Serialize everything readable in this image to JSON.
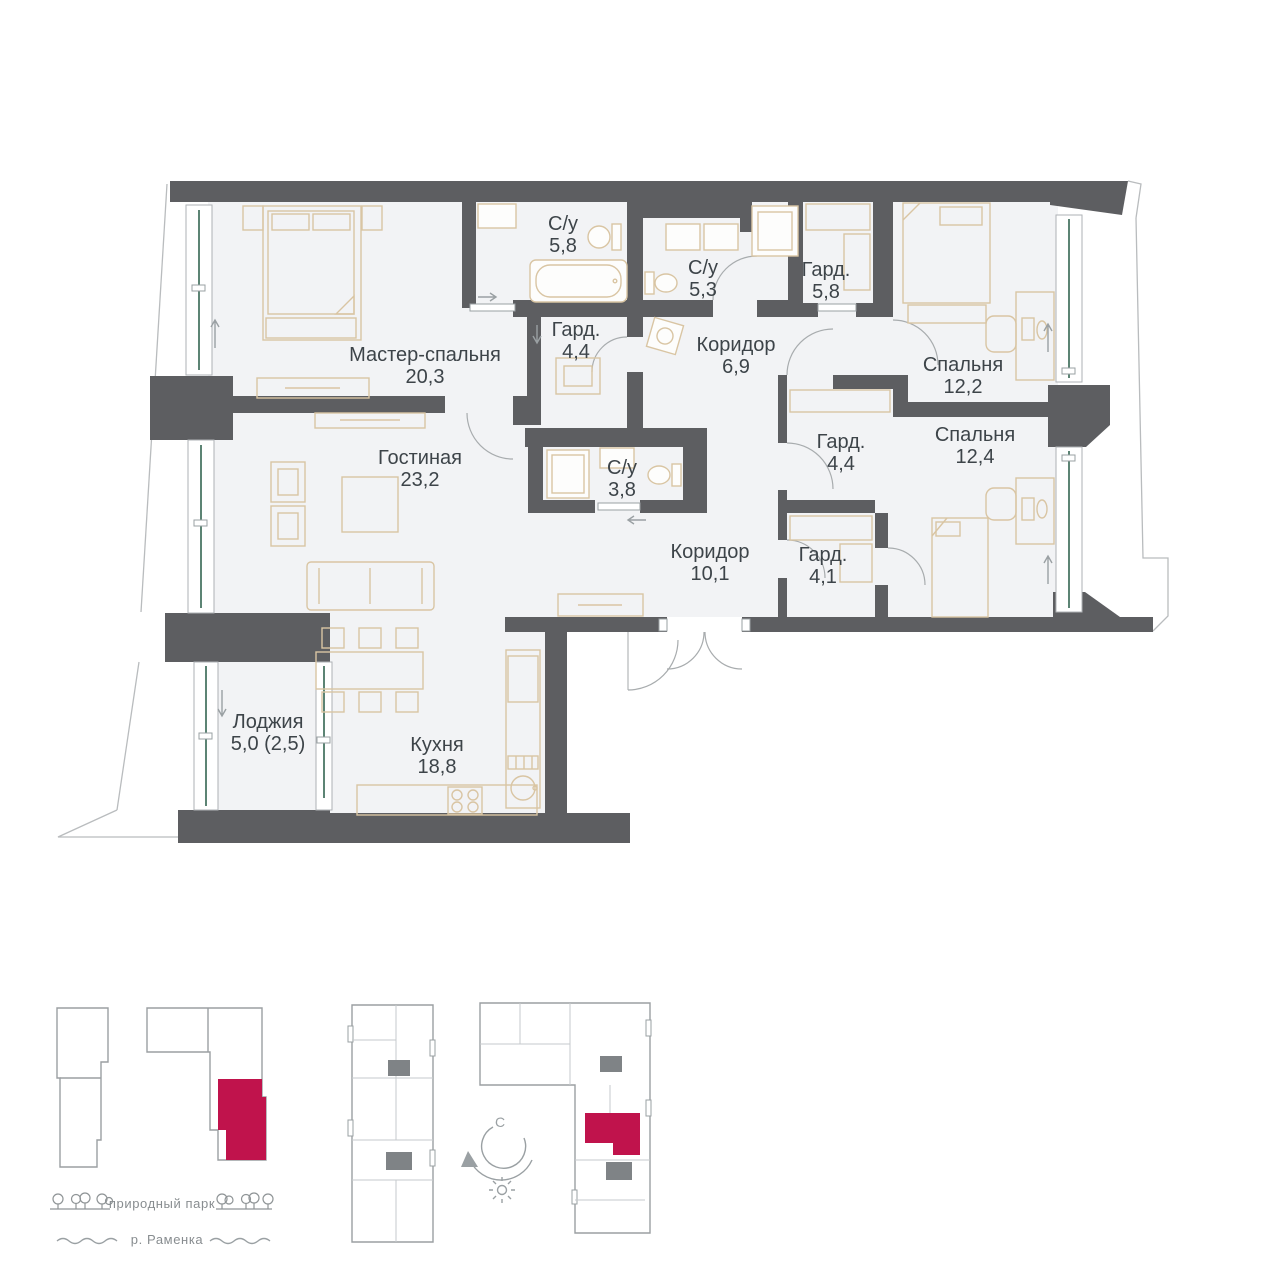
{
  "plan": {
    "rooms": [
      {
        "name": "Мастер-спальня",
        "area": "20,3"
      },
      {
        "name": "С/у",
        "area": "5,8"
      },
      {
        "name": "С/у",
        "area": "5,3"
      },
      {
        "name": "Гард.",
        "area": "5,8"
      },
      {
        "name": "Гард.",
        "area": "4,4"
      },
      {
        "name": "Коридор",
        "area": "6,9"
      },
      {
        "name": "Спальня",
        "area": "12,2"
      },
      {
        "name": "Гостиная",
        "area": "23,2"
      },
      {
        "name": "С/у",
        "area": "3,8"
      },
      {
        "name": "Гард.",
        "area": "4,4"
      },
      {
        "name": "Спальня",
        "area": "12,4"
      },
      {
        "name": "Коридор",
        "area": "10,1"
      },
      {
        "name": "Гард.",
        "area": "4,1"
      },
      {
        "name": "Лоджия",
        "area": "5,0 (2,5)"
      },
      {
        "name": "Кухня",
        "area": "18,8"
      }
    ]
  },
  "legend": {
    "park": "природный парк",
    "river": "р. Раменка",
    "compass_north": "С"
  },
  "colors": {
    "wall": "#5d5e61",
    "floor": "#f2f3f5",
    "furniture": "#d9c5a3",
    "glass": "#5c8474",
    "accent_red": "#c0134c",
    "label_text": "#3d4449",
    "legend_text": "#888d90"
  }
}
